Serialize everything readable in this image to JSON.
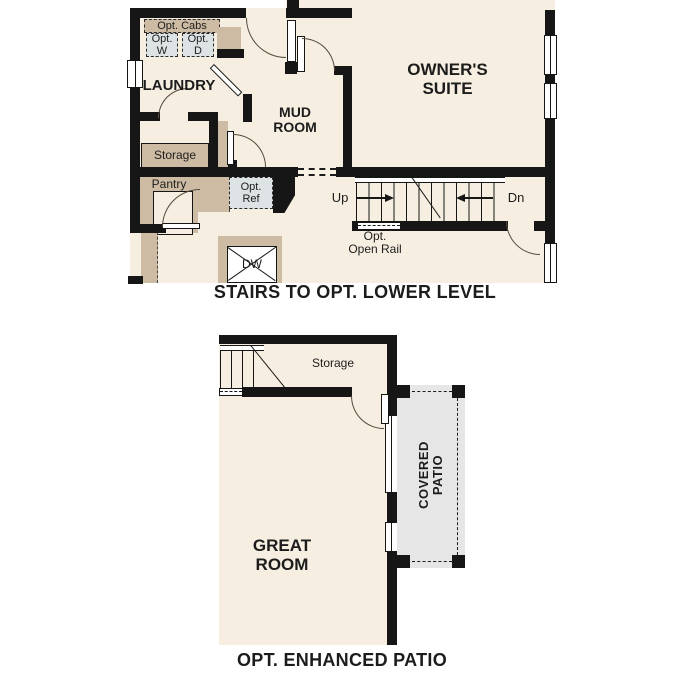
{
  "colors": {
    "wall": "#161616",
    "floor": "#f6efe1",
    "counter": "#cdbca3",
    "appliance_gray": "#dde2e5",
    "patio_gray": "#e6e6e6",
    "text": "#1c1c1c"
  },
  "upper_plan": {
    "title": "STAIRS TO OPT. LOWER LEVEL",
    "labels": {
      "opt_cabs": "Opt. Cabs",
      "opt_washer": [
        "Opt.",
        "W"
      ],
      "opt_dryer": [
        "Opt.",
        "D"
      ],
      "laundry": "LAUNDRY",
      "mud_room": [
        "MUD",
        "ROOM"
      ],
      "owners_suite": [
        "OWNER'S",
        "SUITE"
      ],
      "storage": "Storage",
      "pantry": "Pantry",
      "opt_ref": [
        "Opt.",
        "Ref"
      ],
      "dishwasher": "DW",
      "up": "Up",
      "down": "Dn",
      "opt_open_rail": [
        "Opt.",
        "Open Rail"
      ]
    }
  },
  "lower_plan": {
    "title": "OPT. ENHANCED PATIO",
    "labels": {
      "storage": "Storage",
      "great_room": [
        "GREAT",
        "ROOM"
      ],
      "covered_patio": [
        "COVERED",
        "PATIO"
      ]
    }
  }
}
